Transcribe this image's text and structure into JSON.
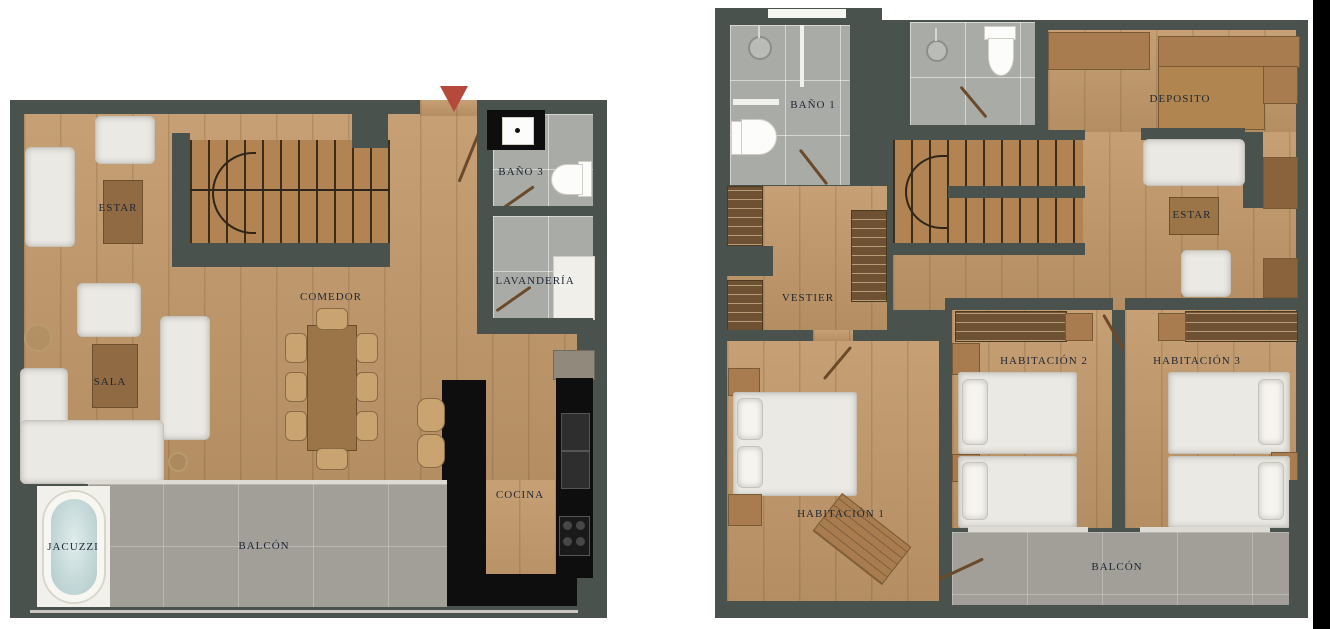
{
  "page": {
    "background": "#ffffff",
    "description_title": ""
  },
  "palette": {
    "wall": "#49524c",
    "wood_floor": "#c2996a",
    "stair_wood": "#b28453",
    "closet_wood": "#a87c4e",
    "dark_table_wood": "#8f6a42",
    "bath_tile": "#a9aba7",
    "balcony_tile": "#a19f98",
    "white_furniture": "#ebe9e3",
    "kitchen_counter": "#0e0e0e",
    "jacuzzi_water": "#c5d9d9",
    "entry_arrow": "#b5493b",
    "label_text": "#1f2633",
    "right_edge_band": "#000000"
  },
  "floors": [
    {
      "name": "first-floor-plan",
      "rooms": [
        {
          "label": "ESTAR"
        },
        {
          "label": "SALA"
        },
        {
          "label": "COMEDOR"
        },
        {
          "label": "BAÑO 3"
        },
        {
          "label": "LAVANDERÍA"
        },
        {
          "label": "COCINA"
        },
        {
          "label": "JACUZZI"
        },
        {
          "label": "BALCÓN"
        }
      ],
      "entry_marker": "red-triangle-arrow"
    },
    {
      "name": "second-floor-plan",
      "rooms": [
        {
          "label": "BAÑO 1"
        },
        {
          "label": "DEPOSITO"
        },
        {
          "label": "ESTAR"
        },
        {
          "label": "VESTIER"
        },
        {
          "label": "HABITACIÓN 1"
        },
        {
          "label": "HABITACIÓN 2"
        },
        {
          "label": "HABITACIÓN 3"
        },
        {
          "label": "BALCÓN"
        }
      ]
    }
  ]
}
